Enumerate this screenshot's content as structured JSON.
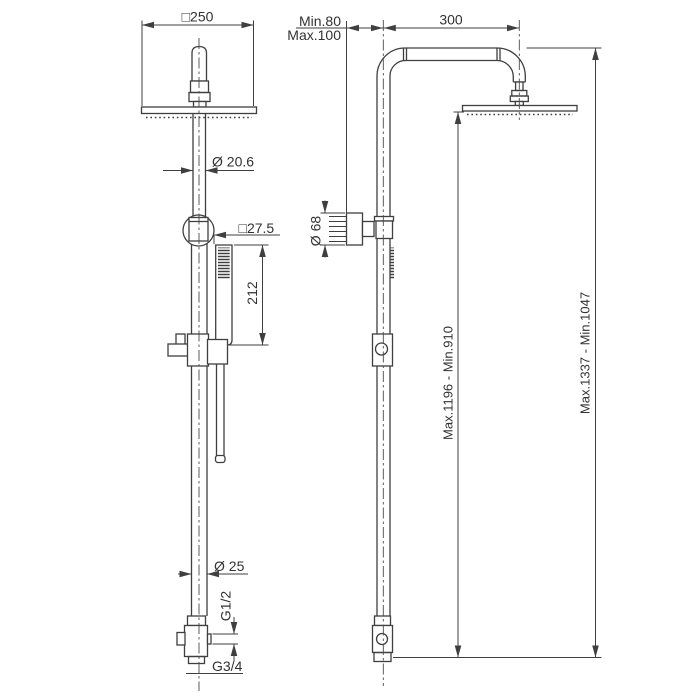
{
  "front": {
    "head_width": "□250",
    "upper_pipe_diameter": "Ø 20.6",
    "handshower_section": "□27.5",
    "handshower_length": "212",
    "column_diameter": "Ø 25",
    "side_outlet_thread": "G1/2",
    "bottom_inlet_thread": "G3/4"
  },
  "side": {
    "wall_distance_min": "Min.80",
    "wall_distance_max": "Max.100",
    "arm_projection": "300",
    "bracket_diameter": "Ø 68",
    "height_head_underside": "Max.1196 - Min.910",
    "height_overall": "Max.1337 - Min.1047"
  },
  "style": {
    "line_color": "#3f3f3f",
    "background": "#ffffff"
  }
}
